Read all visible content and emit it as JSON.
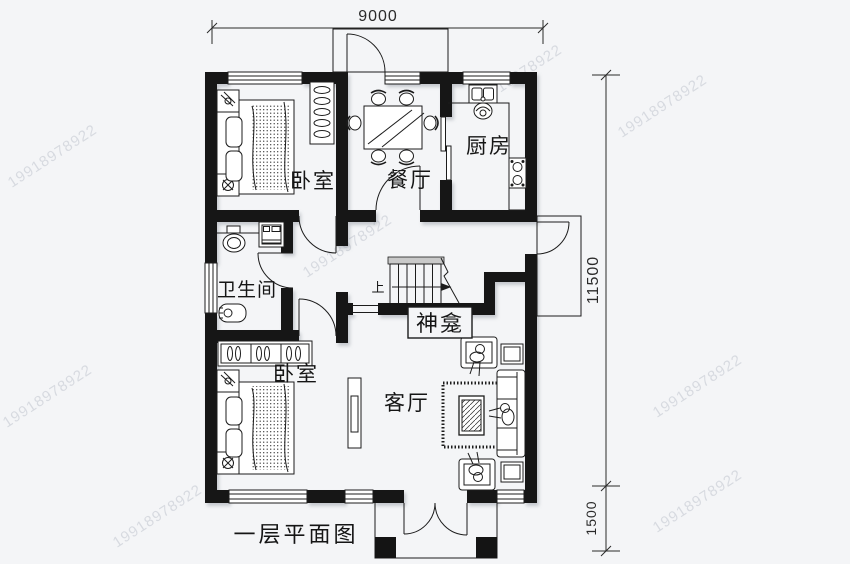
{
  "page": {
    "title_label": "一层平面图"
  },
  "rooms": {
    "bedroom_top": "卧室",
    "dining": "餐厅",
    "kitchen": "厨房",
    "bathroom": "卫生间",
    "bedroom_bottom": "卧室",
    "living": "客厅",
    "shrine": "神龛"
  },
  "stairs": {
    "up": "上"
  },
  "dimensions": {
    "top_width": "9000",
    "right_height": "11500",
    "porch_depth": "1500"
  },
  "watermark": {
    "text": "19918978922"
  },
  "colors": {
    "background": "#f4f5f7",
    "wall": "#141414",
    "line": "#1c1c1c",
    "watermark": "#aab0bd"
  }
}
